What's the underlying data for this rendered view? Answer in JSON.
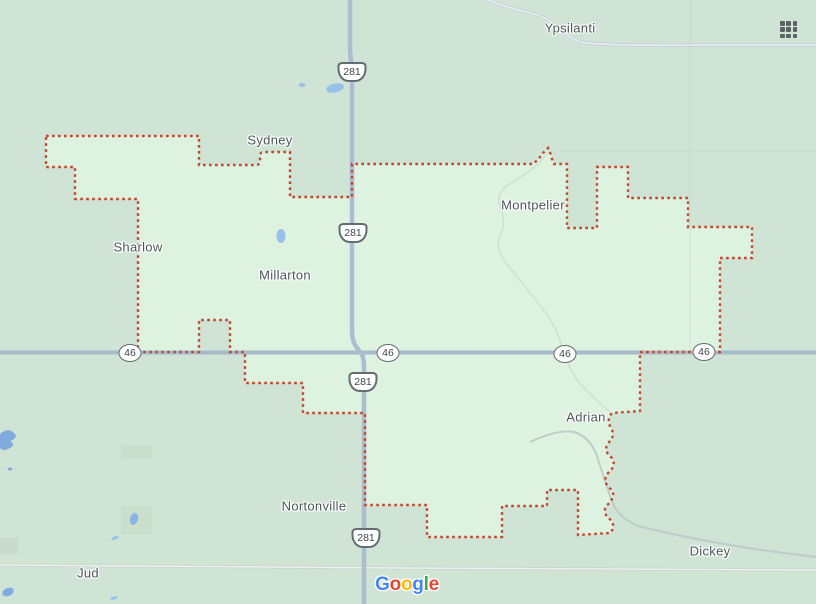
{
  "map_labels": {
    "towns": [
      {
        "name": "Ypsilanti"
      },
      {
        "name": "Sydney"
      },
      {
        "name": "Montpelier"
      },
      {
        "name": "Sharlow"
      },
      {
        "name": "Millarton"
      },
      {
        "name": "Adrian"
      },
      {
        "name": "Nortonville"
      },
      {
        "name": "Dickey"
      },
      {
        "name": "Jud"
      }
    ]
  },
  "route_shields": {
    "us_route_number": "281",
    "state_route_number": "46"
  },
  "branding": {
    "logo_text": "Google",
    "logo_letters": [
      {
        "char": "G",
        "color": "#4285F4"
      },
      {
        "char": "o",
        "color": "#EA4335"
      },
      {
        "char": "o",
        "color": "#FBBC05"
      },
      {
        "char": "g",
        "color": "#4285F4"
      },
      {
        "char": "l",
        "color": "#34A853"
      },
      {
        "char": "e",
        "color": "#EA4335"
      }
    ]
  },
  "icons": {
    "apps_grid": "apps-grid-icon"
  },
  "colors": {
    "map_background": "#cfe4d5",
    "selected_region_fill": "#def2e0",
    "selected_region_border": "#c4452c",
    "major_road": "#a7bac9",
    "highway_281_road": "#adbdd1",
    "minor_road": "#c5d1d2",
    "water": "#97c1e8",
    "label_text": "#4f565a"
  }
}
